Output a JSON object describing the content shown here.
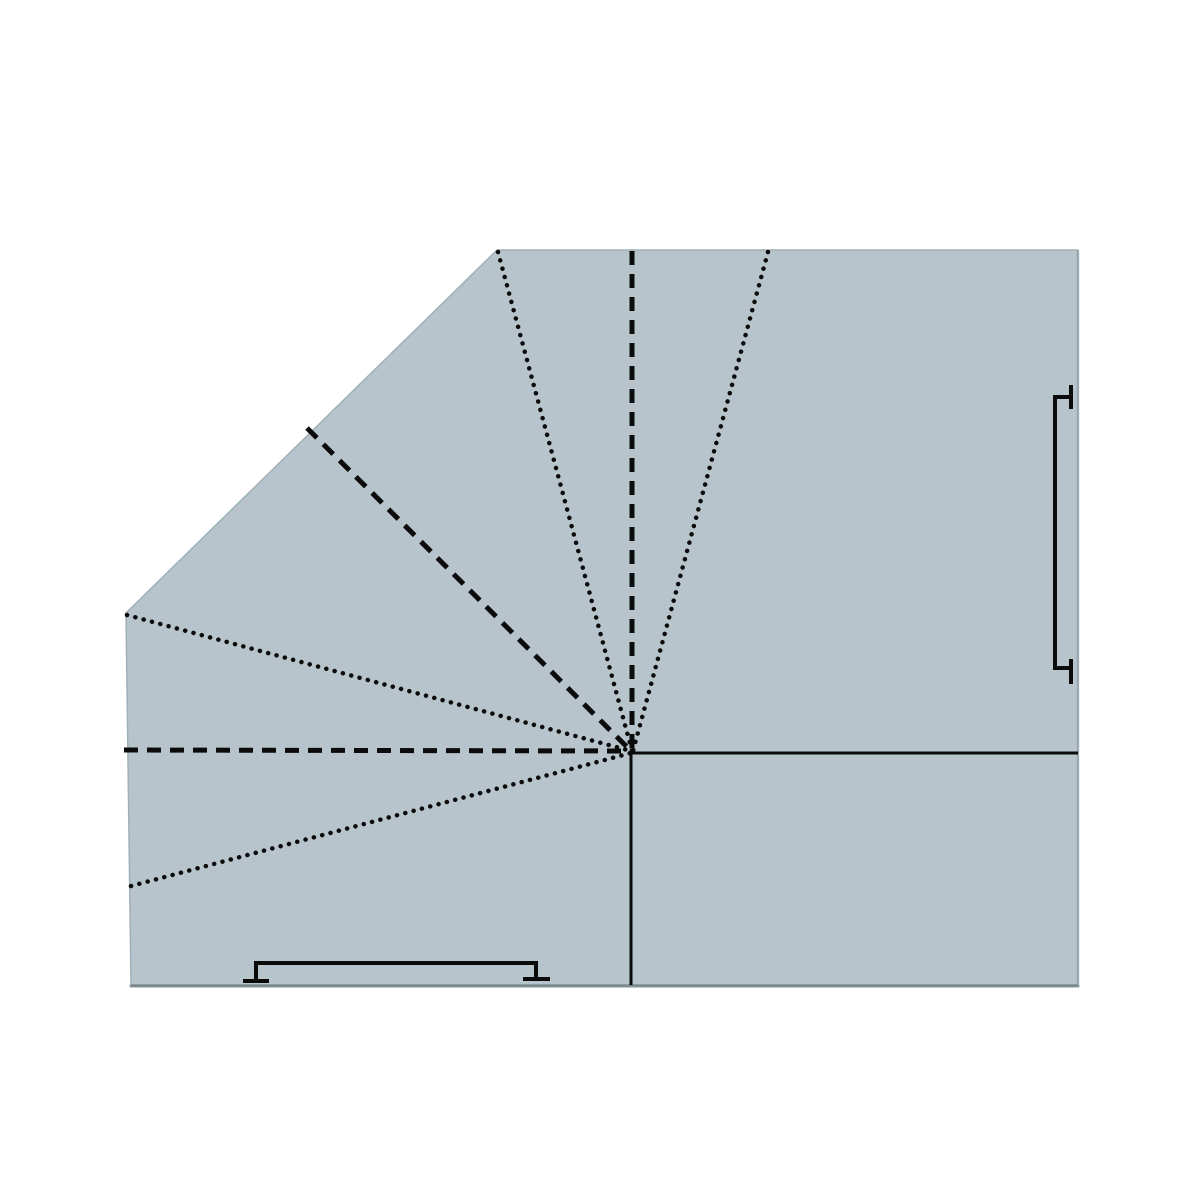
{
  "canvas": {
    "width": 1200,
    "height": 1200,
    "background": "#ffffff"
  },
  "palette": {
    "paper_fill": "#b7c4cb",
    "paper_edge": "#9fb0b8",
    "bottom_edge_shade": "#5f6f77",
    "right_edge_shade": "#8a9aa2",
    "line_color": "#0b0b0b"
  },
  "paper": {
    "points": [
      [
        497,
        250
      ],
      [
        1078,
        250
      ],
      [
        1078,
        985
      ],
      [
        131,
        985
      ],
      [
        126,
        613
      ]
    ]
  },
  "edge_shading": [
    {
      "name": "bottom-edge-shade",
      "x1": 131,
      "y1": 986,
      "x2": 1078,
      "y2": 986,
      "width": 3,
      "opacity": 0.75
    },
    {
      "name": "right-edge-shade",
      "x1": 1078,
      "y1": 251,
      "x2": 1078,
      "y2": 985,
      "width": 2.5,
      "opacity": 0.55
    }
  ],
  "line_styles": {
    "dotted": {
      "width": 4.5,
      "dasharray": "0.1 8.5",
      "linecap": "round"
    },
    "dashed": {
      "width": 5,
      "dasharray": "14 9",
      "linecap": "butt"
    },
    "solid": {
      "width": 3,
      "dasharray": "",
      "linecap": "butt"
    }
  },
  "fold_lines": [
    {
      "name": "fold-dashed-vertical-top",
      "style": "dashed",
      "x1": 632,
      "y1": 251,
      "x2": 632,
      "y2": 750
    },
    {
      "name": "fold-dotted-upper-left",
      "style": "dotted",
      "x1": 498,
      "y1": 252,
      "x2": 632,
      "y2": 751
    },
    {
      "name": "fold-dotted-upper-right",
      "style": "dotted",
      "x1": 768,
      "y1": 252,
      "x2": 633,
      "y2": 751
    },
    {
      "name": "fold-dashed-diagonal",
      "style": "dashed",
      "x1": 307,
      "y1": 428,
      "x2": 631,
      "y2": 751
    },
    {
      "name": "fold-dotted-left-vertex",
      "style": "dotted",
      "x1": 127,
      "y1": 615,
      "x2": 631,
      "y2": 751
    },
    {
      "name": "fold-dashed-horizontal-left",
      "style": "dashed",
      "x1": 124,
      "y1": 750,
      "x2": 631,
      "y2": 751
    },
    {
      "name": "fold-dotted-lower-left",
      "style": "dotted",
      "x1": 131,
      "y1": 886,
      "x2": 631,
      "y2": 753
    },
    {
      "name": "cut-solid-horizontal-right",
      "style": "solid",
      "x1": 632,
      "y1": 753,
      "x2": 1078,
      "y2": 753
    },
    {
      "name": "cut-solid-vertical-bottom",
      "style": "solid",
      "x1": 631,
      "y1": 752,
      "x2": 631,
      "y2": 985
    }
  ],
  "brackets": {
    "stroke_width": 4,
    "items": [
      {
        "name": "bottom-edge-bracket",
        "path": "M 243 981 L 269 981 M 256 981 L 256 963 L 536 963 L 536 979 M 523 979 L 550 979"
      },
      {
        "name": "right-edge-bracket",
        "path": "M 1071 385 L 1071 409 M 1071 397 L 1055 397 L 1055 668 L 1071 668 M 1071 659 L 1071 684"
      }
    ]
  }
}
